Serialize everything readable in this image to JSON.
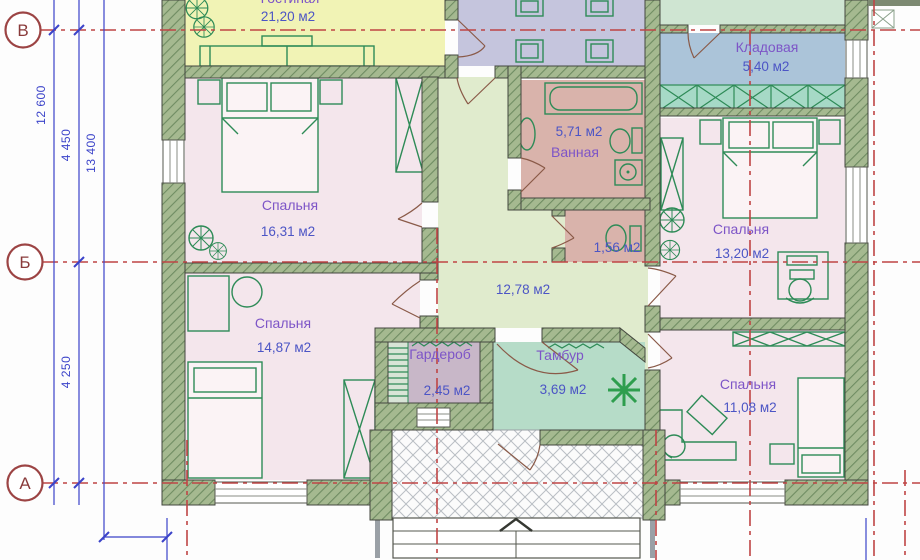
{
  "plan": {
    "axes": {
      "top": "В",
      "middle": "Б",
      "bottom": "А"
    },
    "dimensions": {
      "left_outer": "12 600",
      "left_mid_upper": "4 450",
      "left_inner": "13 400",
      "left_mid_lower": "4 250"
    },
    "rooms": {
      "living": {
        "name": "Гостиная",
        "area": "21,20 м2"
      },
      "kladovaya": {
        "name": "Кладовая",
        "area": "5,40 м2"
      },
      "bathroom": {
        "name": "Ванная",
        "area": "5,71 м2"
      },
      "wc": {
        "area": "1,56 м2"
      },
      "bedroom1": {
        "name": "Спальня",
        "area": "16,31 м2"
      },
      "bedroom2": {
        "name": "Спальня",
        "area": "14,87 м2"
      },
      "bedroom3": {
        "name": "Спальня",
        "area": "13,20 м2"
      },
      "bedroom4": {
        "name": "Спальня",
        "area": "11,08 м2"
      },
      "hall": {
        "area": "12,78 м2"
      },
      "garderob": {
        "name": "Гардероб",
        "area": "2,45 м2"
      },
      "tambur": {
        "name": "Тамбур",
        "area": "3,69 м2"
      }
    },
    "colors": {
      "wall": "#a5b990",
      "living": "#f1f3b5",
      "dining": "#c5c5dd",
      "kladovaya": "#abc4d9",
      "bedroom": "#f4e6ec",
      "bath": "#d9b3ab",
      "hall": "#e0ebcd",
      "tambur": "#b6dcc8",
      "garderob": "#c8b7c8",
      "hallway_top": "#cfe5d2",
      "label_name": "#7d55c7",
      "label_area": "#4c55c5",
      "axis_red": "#bf4545",
      "dim_blue": "#3b43c9",
      "furniture_green": "#2e8b57"
    }
  }
}
